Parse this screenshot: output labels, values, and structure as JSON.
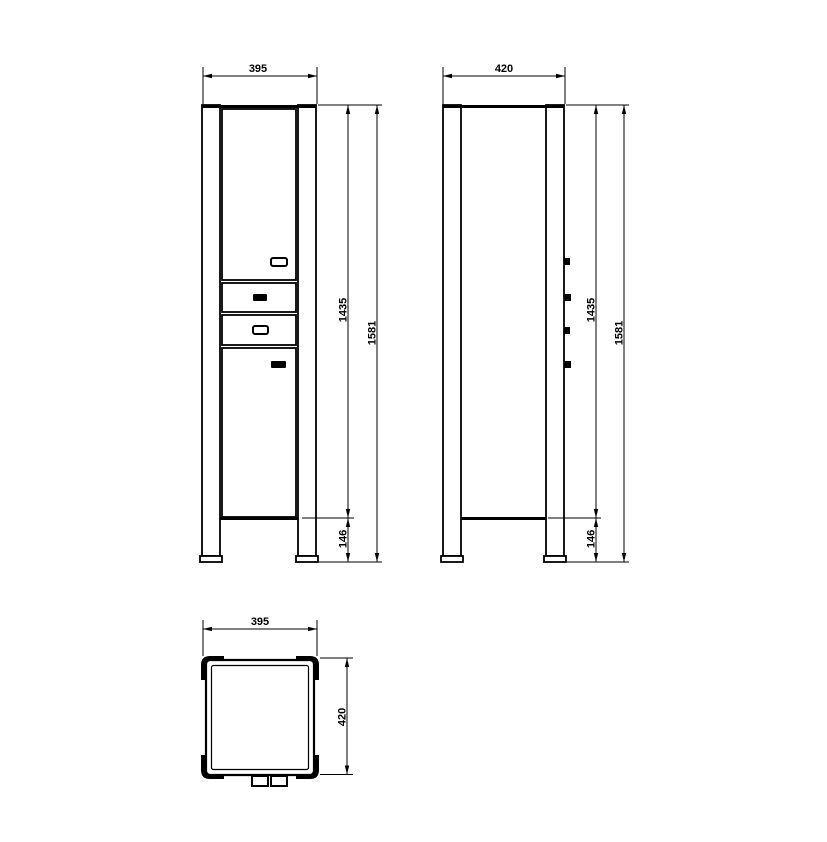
{
  "page": {
    "background": "#ffffff",
    "line_color": "#000000"
  },
  "drawing": {
    "kind": "cabinet-dimension-drawing",
    "views": {
      "front": {
        "width": "395",
        "body_height": "1435",
        "total_height": "1581",
        "leg_height": "146"
      },
      "side": {
        "depth": "420",
        "body_height": "1435",
        "total_height": "1581",
        "leg_height": "146"
      },
      "top": {
        "width": "395",
        "depth": "420"
      }
    }
  }
}
